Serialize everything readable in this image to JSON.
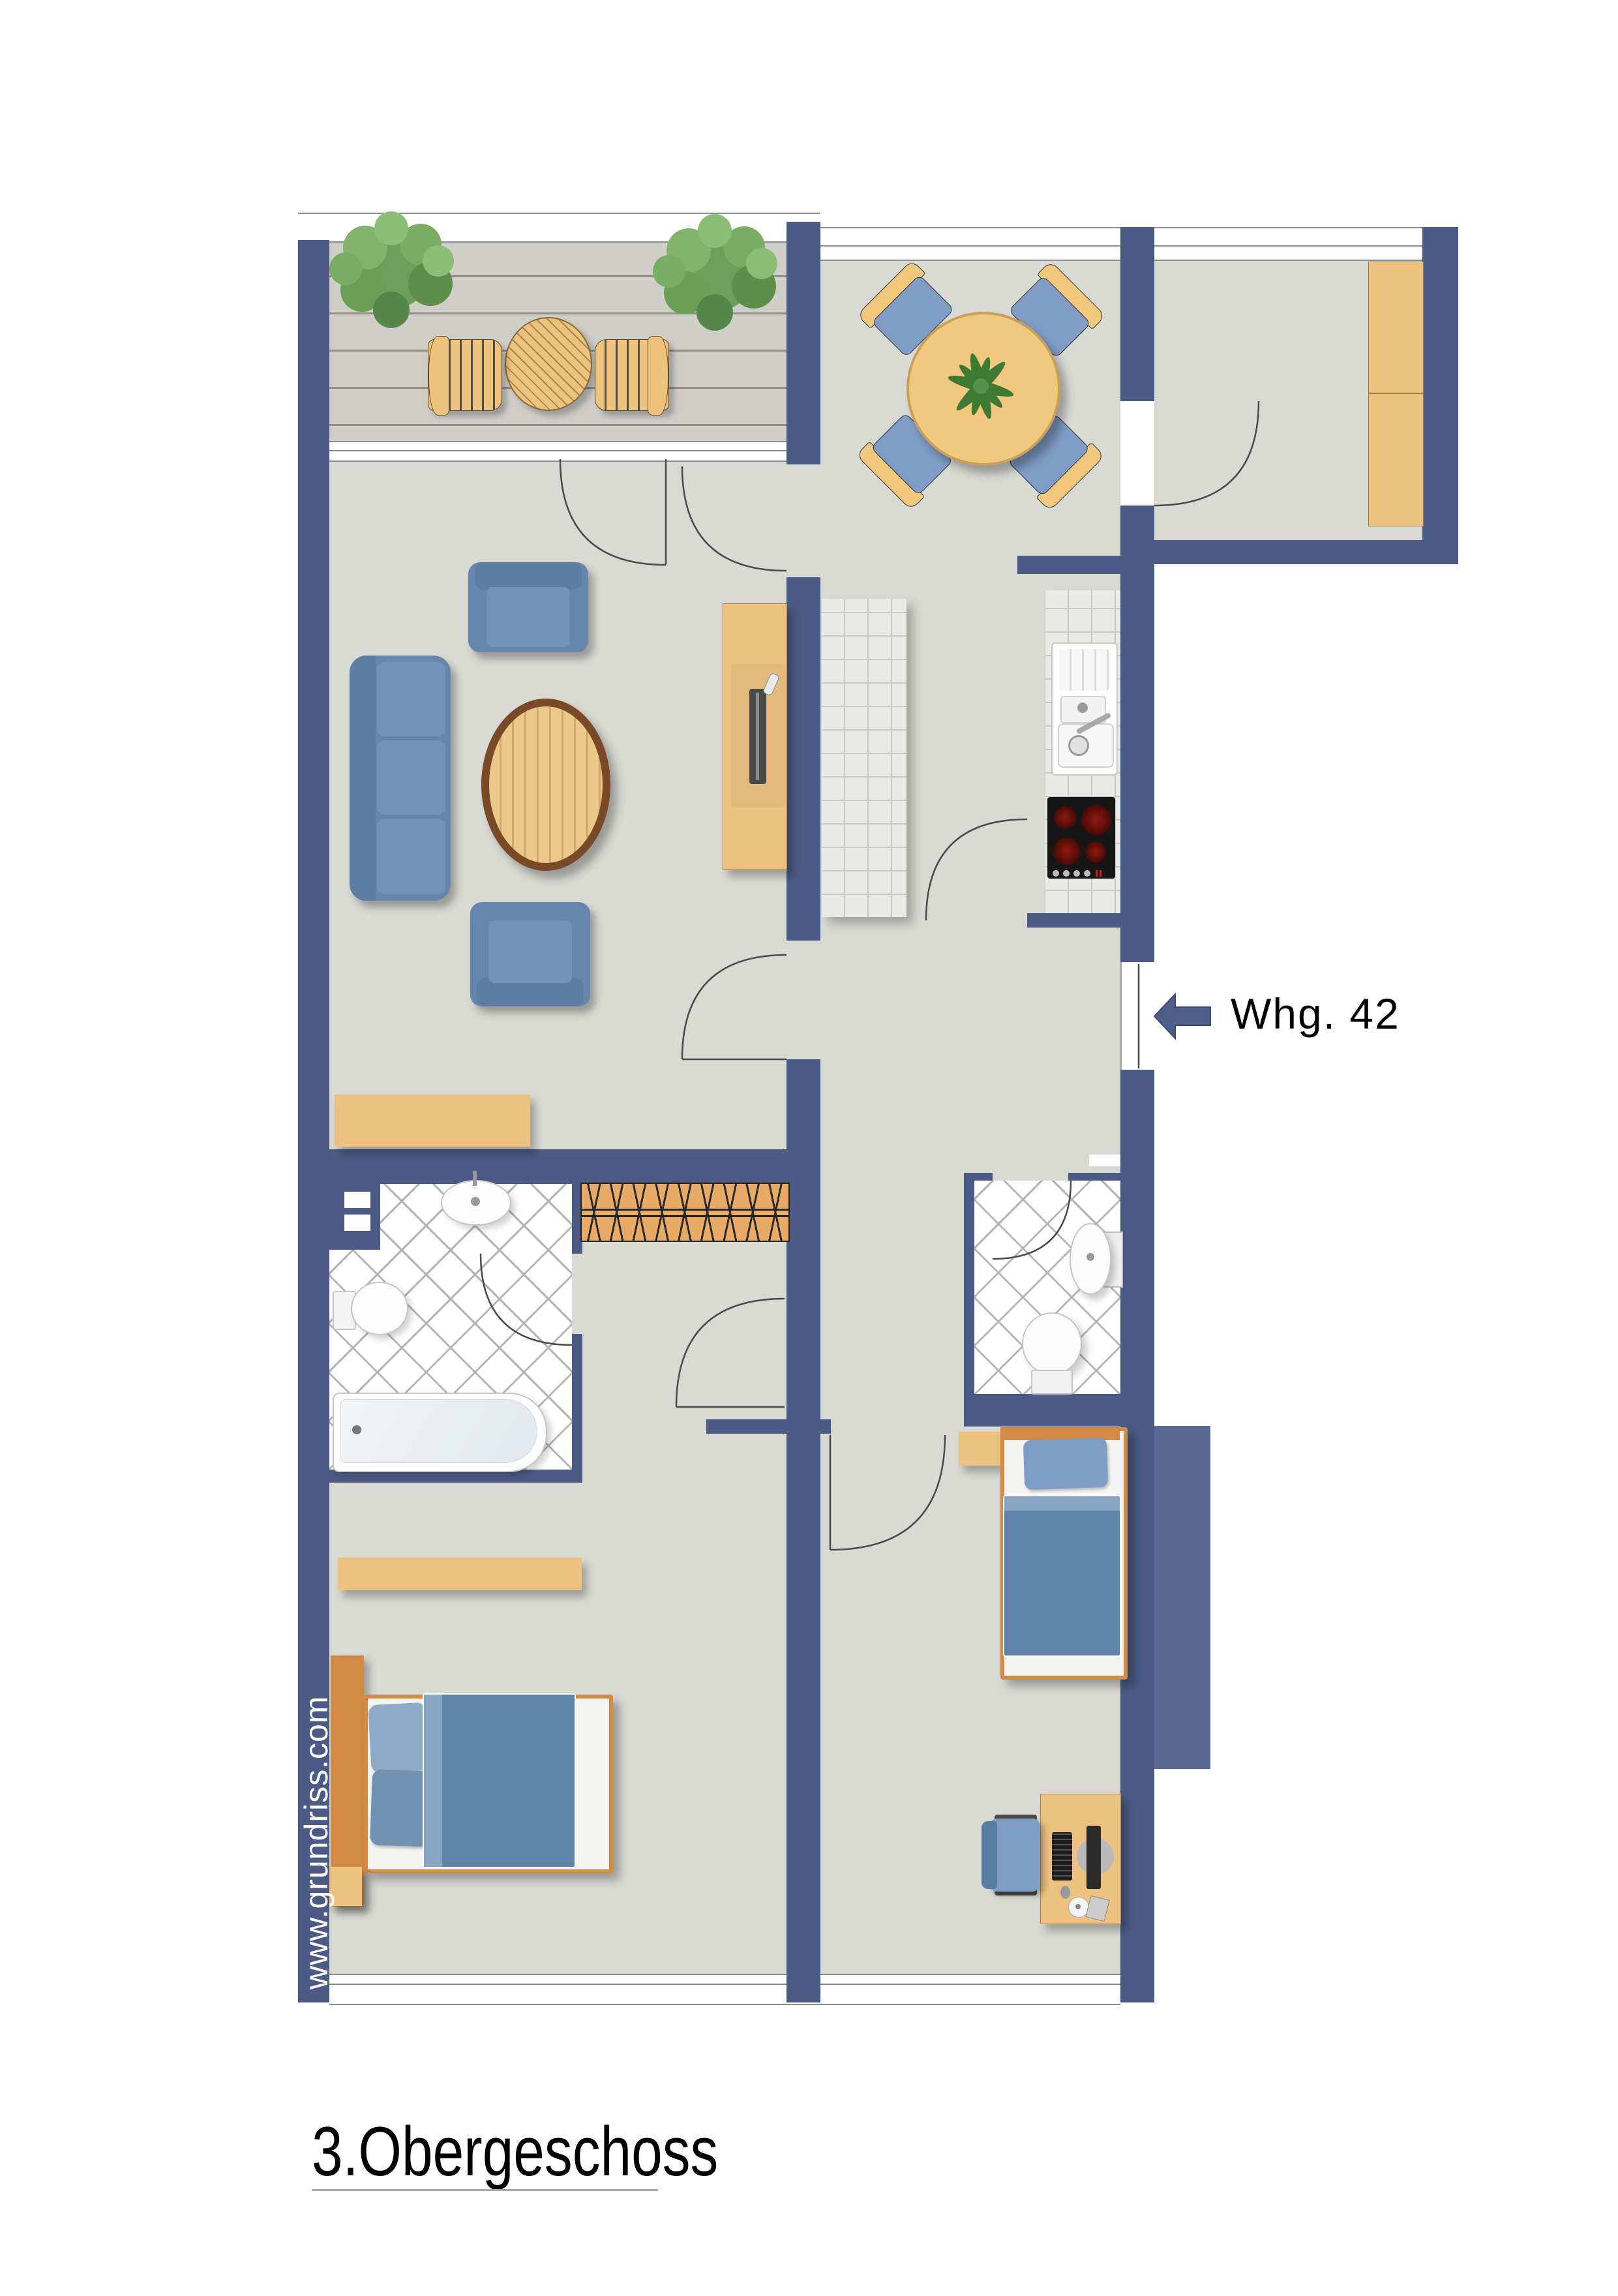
{
  "title": "3.Obergeschoss",
  "entrance": {
    "apartment_label": "Whg. 42",
    "arrow_icon": "left-arrow"
  },
  "watermark": "www.grundriss.com",
  "colors": {
    "wall": "#4b5b85",
    "wall_light": "#5a6a92",
    "floor": "#d9dad4",
    "deck": "#d0cec9",
    "wood": "#edc281",
    "wood_dark": "#d28a45",
    "fabric": "#6886ad",
    "duvet": "#5e83a8",
    "cushion": "#7f9dc4",
    "tile_line": "#b4b4b4",
    "text": "#000000"
  }
}
